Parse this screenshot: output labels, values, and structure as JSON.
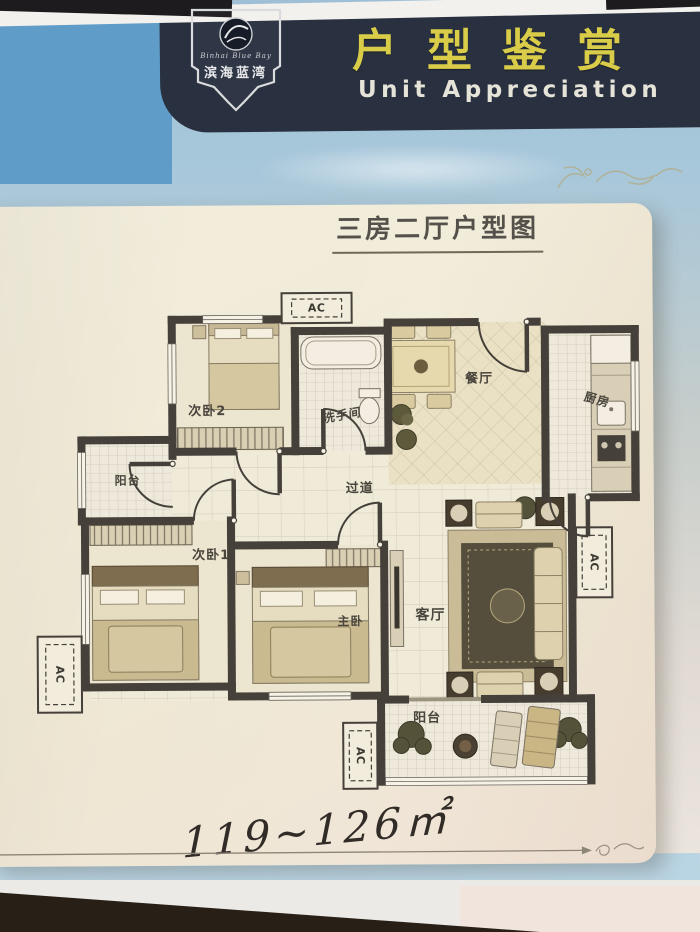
{
  "header": {
    "badge": {
      "script_name": "Binhai Blue Bay",
      "brand": "滨海蓝湾"
    },
    "title": "户型鉴赏",
    "subtitle": "Unit Appreciation"
  },
  "card": {
    "plan_type_title": "三房二厅户型图",
    "area_range": "119~126㎡"
  },
  "floorplan": {
    "ac_label": "AC",
    "rooms": [
      {
        "id": "bedroom-2",
        "label": "次卧2"
      },
      {
        "id": "bathroom",
        "label": "洗手间"
      },
      {
        "id": "dining-room",
        "label": "餐厅"
      },
      {
        "id": "kitchen",
        "label": "厨房"
      },
      {
        "id": "balcony-left",
        "label": "阳台"
      },
      {
        "id": "corridor",
        "label": "过道"
      },
      {
        "id": "bedroom-1",
        "label": "次卧1"
      },
      {
        "id": "master-bedroom",
        "label": "主卧"
      },
      {
        "id": "living-room",
        "label": "客厅"
      },
      {
        "id": "balcony-bottom",
        "label": "阳台"
      }
    ]
  },
  "colors": {
    "header_band": "#29303f",
    "header_title_yellow": "#d9cc49",
    "header_subtitle": "#e6e4d8",
    "sky_blue": "#a7c7da",
    "panel_blue": "#5f9dc8",
    "card_cream": "#f0ead8",
    "wall_dark": "#46403a",
    "ornament_gold": "#b89f5e"
  }
}
